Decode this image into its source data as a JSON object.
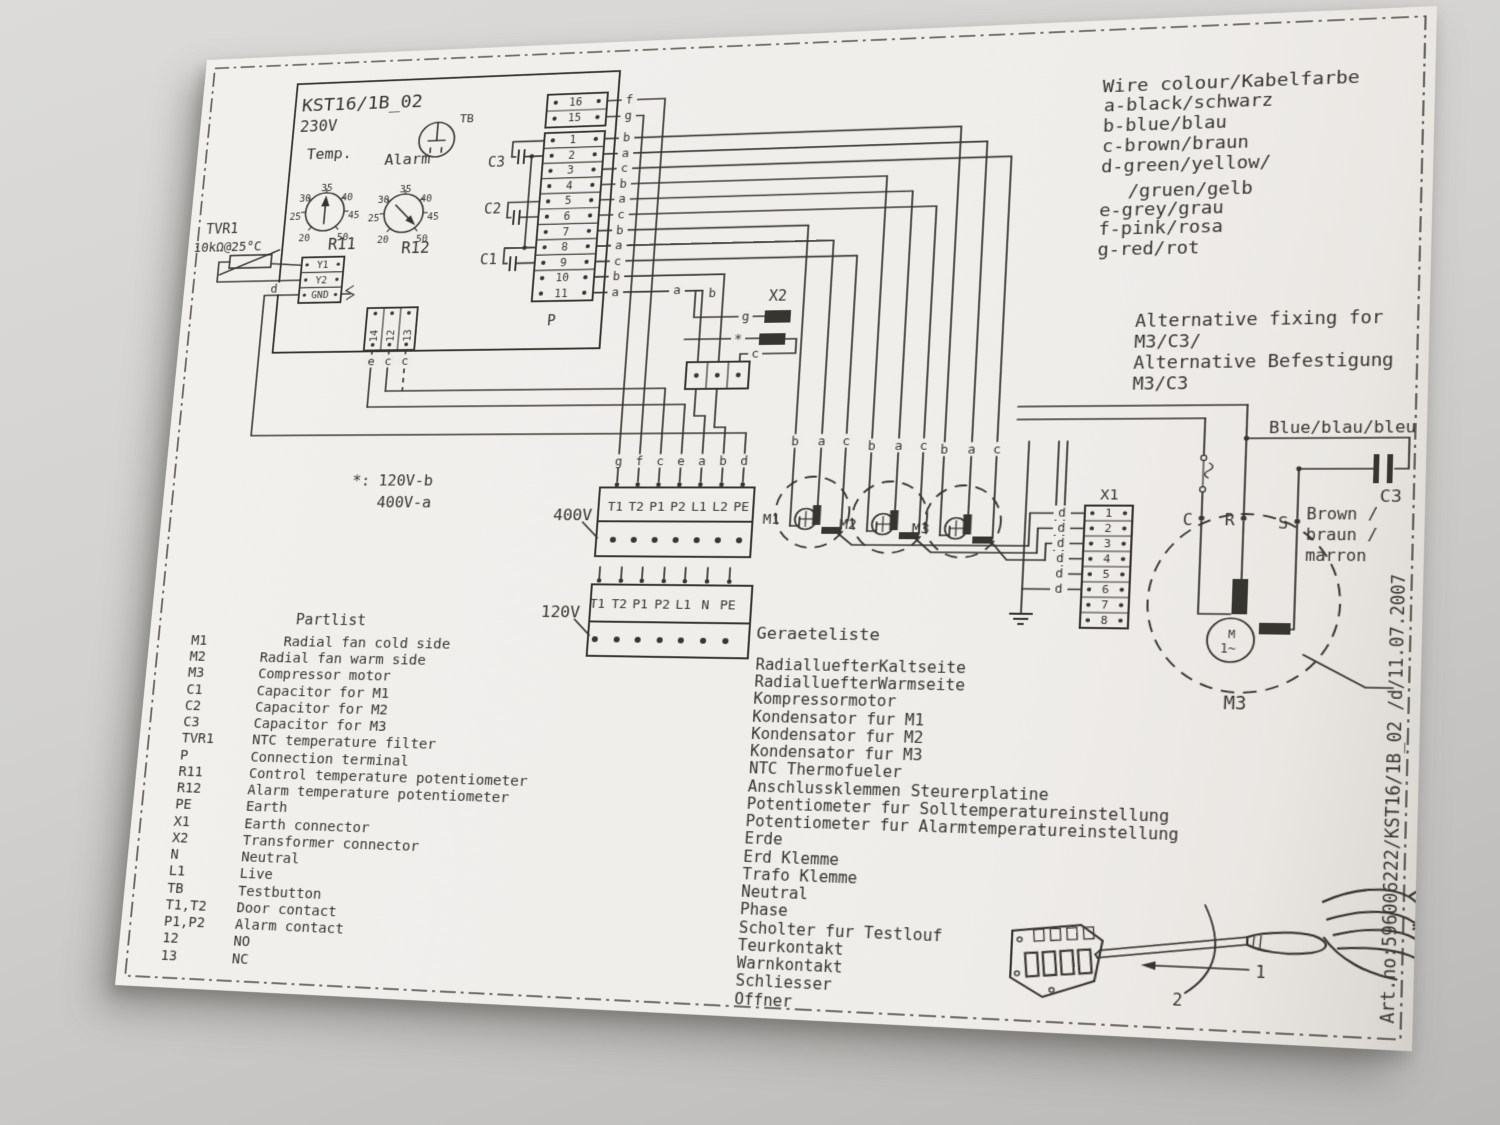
{
  "board": {
    "title": "KST16/1B_02",
    "voltage": "230V",
    "tb": "TB",
    "temp": "Temp.",
    "alarm": "Alarm",
    "r11": "R11",
    "r12": "R12",
    "dial_ticks": [
      "35",
      "40",
      "45",
      "50",
      "20",
      "25",
      "30"
    ],
    "tvr1": "TVR1",
    "tvr1_value": "10kΩ@25°C",
    "relay_rows": [
      "Y1",
      "Y2",
      "GND"
    ],
    "d": "d",
    "p": "P",
    "caps": [
      "C3",
      "C2",
      "C1"
    ],
    "aux_pins": [
      "14",
      "12",
      "13"
    ],
    "aux_wires": [
      "e",
      "c",
      "c"
    ]
  },
  "p_pins": [
    {
      "n": "16",
      "w": "f"
    },
    {
      "n": "15",
      "w": "g"
    },
    {
      "n": "1",
      "w": "b"
    },
    {
      "n": "2",
      "w": "a"
    },
    {
      "n": "3",
      "w": "c"
    },
    {
      "n": "4",
      "w": "b"
    },
    {
      "n": "5",
      "w": "a"
    },
    {
      "n": "6",
      "w": "c"
    },
    {
      "n": "7",
      "w": "b"
    },
    {
      "n": "8",
      "w": "a"
    },
    {
      "n": "9",
      "w": "c"
    },
    {
      "n": "10",
      "w": "b"
    },
    {
      "n": "11",
      "w": "a"
    }
  ],
  "legend": {
    "title": "Wire colour/Kabelfarbe",
    "entries": [
      "a-black/schwarz",
      "b-blue/blau",
      "c-brown/braun",
      "d-green/yellow/",
      "/gruen/gelb",
      "e-grey/grau",
      "f-pink/rosa",
      "g-red/rot"
    ]
  },
  "alt": {
    "l1": "Alternative fixing for",
    "l2": "M3/C3/",
    "l3": "Alternative Befestigung",
    "l4": "M3/C3",
    "blue": "Blue/blau/bleu",
    "c3": "C3",
    "c": "C",
    "r": "R",
    "s": "S",
    "brown": [
      "Brown /",
      "braun /",
      "marron"
    ],
    "m3": "M3",
    "m": "M",
    "wave": "1~"
  },
  "note": {
    "star": "*:",
    "v1": "120V-b",
    "v2": "400V-a"
  },
  "x2": {
    "label": "X2",
    "g": "g",
    "star": "*",
    "c": "c",
    "a": "a",
    "b": "b"
  },
  "x1": {
    "label": "X1",
    "pins": [
      "1",
      "2",
      "3",
      "4",
      "5",
      "6",
      "7",
      "8"
    ],
    "w": "d"
  },
  "t400": {
    "label": "400V",
    "cols": [
      "T1",
      "T2",
      "P1",
      "P2",
      "L1",
      "L2",
      "PE"
    ],
    "wires": [
      "g",
      "f",
      "c",
      "e",
      "a",
      "b",
      "d"
    ]
  },
  "t120": {
    "label": "120V",
    "cols": [
      "T1",
      "T2",
      "P1",
      "P2",
      "L1",
      "N",
      "PE"
    ]
  },
  "motors": [
    {
      "label": "M1"
    },
    {
      "label": "M2"
    },
    {
      "label": "M3"
    }
  ],
  "motor_wires": [
    "b",
    "a",
    "c"
  ],
  "partlist": {
    "title": "Partlist",
    "items": [
      {
        "key": "M1",
        "desc": "Radial fan cold side"
      },
      {
        "key": "M2",
        "desc": "Radial fan warm side"
      },
      {
        "key": "M3",
        "desc": "Compressor motor"
      },
      {
        "key": "C1",
        "desc": "Capacitor for M1"
      },
      {
        "key": "C2",
        "desc": "Capacitor for M2"
      },
      {
        "key": "C3",
        "desc": "Capacitor for M3"
      },
      {
        "key": "TVR1",
        "desc": "NTC temperature filter"
      },
      {
        "key": "P",
        "desc": "Connection terminal"
      },
      {
        "key": "R11",
        "desc": "Control temperature potentiometer"
      },
      {
        "key": "R12",
        "desc": "Alarm temperature potentiometer"
      },
      {
        "key": "PE",
        "desc": "Earth"
      },
      {
        "key": "X1",
        "desc": "Earth connector"
      },
      {
        "key": "X2",
        "desc": "Transformer connector"
      },
      {
        "key": "N",
        "desc": "Neutral"
      },
      {
        "key": "L1",
        "desc": "Live"
      },
      {
        "key": "TB",
        "desc": "Testbutton"
      },
      {
        "key": "T1,T2",
        "desc": "Door contact"
      },
      {
        "key": "P1,P2",
        "desc": "Alarm contact"
      },
      {
        "key": "12",
        "desc": "NO"
      },
      {
        "key": "13",
        "desc": "NC"
      }
    ]
  },
  "geraeteliste": {
    "title": "Geraeteliste",
    "items": [
      "RadialluefterKaltseite",
      "RadialluefterWarmseite",
      "Kompressormotor",
      "Kondensator fur M1",
      "Kondensator fur M2",
      "Kondensator fur M3",
      "NTC Thermofueler",
      "Anschlussklemmen Steurerplatine",
      "Potentiometer fur Solltemperatureinstellung",
      "Potentiometer fur Alarmtemperatureinstellung",
      "Erde",
      "Erd Klemme",
      "Trafo Klemme",
      "Neutral",
      "Phase",
      "Scholter fur Testlouf",
      "Teurkontakt",
      "Warnkontakt",
      "Schliesser",
      "Offner"
    ]
  },
  "artno": "Art.no:596006222/KST16/1B_02  /d/11.07.2007",
  "steps": {
    "s1": "1",
    "s2": "2"
  },
  "colors": {
    "ink": "#37352f",
    "paper": "#efedea",
    "wall": "#cfcecb"
  }
}
